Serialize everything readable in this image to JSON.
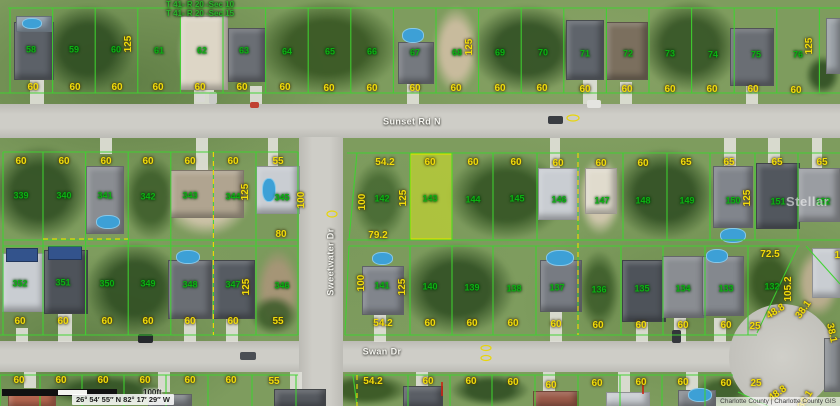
{
  "map": {
    "overlay": {
      "section_labels": [
        "T 41- R 20 -Sec 10",
        "T 41- R 20 -Sec 15"
      ],
      "coordinates": "26° 54′ 55″ N 82° 17′ 29″ W",
      "scale_label": "100ft",
      "attribution": "Charlotte County | Charlotte County GIS",
      "watermark": "Stellar",
      "highlighted_parcel": "143"
    },
    "streets": [
      {
        "id": "sunset-rd-n",
        "name": "Sunset Rd N",
        "x": 412,
        "y": 122,
        "r": 0
      },
      {
        "id": "swan-dr",
        "name": "Swan Dr",
        "x": 382,
        "y": 352,
        "r": 0
      },
      {
        "id": "sweetwater-dr",
        "name": "Sweetwater Dr",
        "x": 331,
        "y": 262,
        "r": -90
      }
    ],
    "parcel_numbers": [
      {
        "n": "58",
        "x": 31,
        "y": 50
      },
      {
        "n": "59",
        "x": 74,
        "y": 50
      },
      {
        "n": "60",
        "x": 116,
        "y": 50
      },
      {
        "n": "61",
        "x": 159,
        "y": 51
      },
      {
        "n": "62",
        "x": 202,
        "y": 51
      },
      {
        "n": "63",
        "x": 244,
        "y": 51
      },
      {
        "n": "64",
        "x": 287,
        "y": 52
      },
      {
        "n": "65",
        "x": 330,
        "y": 52
      },
      {
        "n": "66",
        "x": 372,
        "y": 52
      },
      {
        "n": "67",
        "x": 415,
        "y": 53
      },
      {
        "n": "68",
        "x": 457,
        "y": 53
      },
      {
        "n": "69",
        "x": 500,
        "y": 53
      },
      {
        "n": "70",
        "x": 543,
        "y": 53
      },
      {
        "n": "71",
        "x": 585,
        "y": 54
      },
      {
        "n": "72",
        "x": 628,
        "y": 54
      },
      {
        "n": "73",
        "x": 670,
        "y": 54
      },
      {
        "n": "74",
        "x": 713,
        "y": 55
      },
      {
        "n": "75",
        "x": 756,
        "y": 55
      },
      {
        "n": "76",
        "x": 798,
        "y": 55
      },
      {
        "n": "339",
        "x": 21,
        "y": 196
      },
      {
        "n": "340",
        "x": 64,
        "y": 196
      },
      {
        "n": "341",
        "x": 105,
        "y": 196
      },
      {
        "n": "342",
        "x": 148,
        "y": 197
      },
      {
        "n": "343",
        "x": 190,
        "y": 196
      },
      {
        "n": "344",
        "x": 233,
        "y": 197
      },
      {
        "n": "345",
        "x": 282,
        "y": 198
      },
      {
        "n": "142",
        "x": 382,
        "y": 199
      },
      {
        "n": "143",
        "x": 430,
        "y": 199
      },
      {
        "n": "144",
        "x": 473,
        "y": 200
      },
      {
        "n": "145",
        "x": 517,
        "y": 199
      },
      {
        "n": "146",
        "x": 559,
        "y": 200
      },
      {
        "n": "147",
        "x": 602,
        "y": 201
      },
      {
        "n": "148",
        "x": 643,
        "y": 201
      },
      {
        "n": "149",
        "x": 687,
        "y": 201
      },
      {
        "n": "150",
        "x": 733,
        "y": 201
      },
      {
        "n": "151",
        "x": 778,
        "y": 202
      },
      {
        "n": "152",
        "x": 823,
        "y": 202
      },
      {
        "n": "352",
        "x": 20,
        "y": 284
      },
      {
        "n": "351",
        "x": 63,
        "y": 283
      },
      {
        "n": "350",
        "x": 107,
        "y": 284
      },
      {
        "n": "349",
        "x": 148,
        "y": 284
      },
      {
        "n": "348",
        "x": 190,
        "y": 285
      },
      {
        "n": "347",
        "x": 233,
        "y": 285
      },
      {
        "n": "346",
        "x": 282,
        "y": 286
      },
      {
        "n": "141",
        "x": 382,
        "y": 286
      },
      {
        "n": "140",
        "x": 430,
        "y": 287
      },
      {
        "n": "139",
        "x": 472,
        "y": 288
      },
      {
        "n": "138",
        "x": 514,
        "y": 289
      },
      {
        "n": "137",
        "x": 557,
        "y": 288
      },
      {
        "n": "136",
        "x": 599,
        "y": 290
      },
      {
        "n": "135",
        "x": 642,
        "y": 289
      },
      {
        "n": "134",
        "x": 683,
        "y": 289
      },
      {
        "n": "133",
        "x": 726,
        "y": 289
      },
      {
        "n": "132",
        "x": 772,
        "y": 287
      }
    ],
    "dimensions": [
      {
        "t": "60",
        "x": 33,
        "y": 88
      },
      {
        "t": "60",
        "x": 75,
        "y": 88
      },
      {
        "t": "60",
        "x": 117,
        "y": 88
      },
      {
        "t": "60",
        "x": 158,
        "y": 88
      },
      {
        "t": "60",
        "x": 200,
        "y": 88
      },
      {
        "t": "60",
        "x": 242,
        "y": 88
      },
      {
        "t": "60",
        "x": 285,
        "y": 88
      },
      {
        "t": "60",
        "x": 329,
        "y": 89
      },
      {
        "t": "60",
        "x": 372,
        "y": 89
      },
      {
        "t": "60",
        "x": 415,
        "y": 89
      },
      {
        "t": "60",
        "x": 456,
        "y": 89
      },
      {
        "t": "60",
        "x": 500,
        "y": 89
      },
      {
        "t": "60",
        "x": 542,
        "y": 89
      },
      {
        "t": "60",
        "x": 585,
        "y": 90
      },
      {
        "t": "60",
        "x": 627,
        "y": 90
      },
      {
        "t": "60",
        "x": 670,
        "y": 90
      },
      {
        "t": "60",
        "x": 712,
        "y": 90
      },
      {
        "t": "60",
        "x": 753,
        "y": 90
      },
      {
        "t": "60",
        "x": 796,
        "y": 91
      },
      {
        "t": "125",
        "x": 129,
        "y": 44,
        "r": -90
      },
      {
        "t": "125",
        "x": 470,
        "y": 47,
        "r": -90
      },
      {
        "t": "125",
        "x": 810,
        "y": 46,
        "r": -90
      },
      {
        "t": "60",
        "x": 21,
        "y": 162
      },
      {
        "t": "60",
        "x": 64,
        "y": 162
      },
      {
        "t": "60",
        "x": 106,
        "y": 162
      },
      {
        "t": "60",
        "x": 148,
        "y": 162
      },
      {
        "t": "60",
        "x": 190,
        "y": 162
      },
      {
        "t": "60",
        "x": 233,
        "y": 162
      },
      {
        "t": "55",
        "x": 278,
        "y": 162
      },
      {
        "t": "54.2",
        "x": 385,
        "y": 163
      },
      {
        "t": "60",
        "x": 430,
        "y": 163
      },
      {
        "t": "60",
        "x": 473,
        "y": 163
      },
      {
        "t": "60",
        "x": 516,
        "y": 163
      },
      {
        "t": "60",
        "x": 558,
        "y": 164
      },
      {
        "t": "60",
        "x": 601,
        "y": 164
      },
      {
        "t": "60",
        "x": 643,
        "y": 164
      },
      {
        "t": "65",
        "x": 686,
        "y": 163
      },
      {
        "t": "65",
        "x": 729,
        "y": 163
      },
      {
        "t": "65",
        "x": 777,
        "y": 163
      },
      {
        "t": "65",
        "x": 822,
        "y": 163
      },
      {
        "t": "100",
        "x": 302,
        "y": 200,
        "r": -90
      },
      {
        "t": "125",
        "x": 246,
        "y": 192,
        "r": -90
      },
      {
        "t": "100",
        "x": 363,
        "y": 202,
        "r": -90
      },
      {
        "t": "125",
        "x": 404,
        "y": 198,
        "r": -90
      },
      {
        "t": "125",
        "x": 748,
        "y": 198,
        "r": -90
      },
      {
        "t": "80",
        "x": 281,
        "y": 235
      },
      {
        "t": "79.2",
        "x": 378,
        "y": 236
      },
      {
        "t": "125",
        "x": 247,
        "y": 287,
        "r": -90
      },
      {
        "t": "100",
        "x": 362,
        "y": 283,
        "r": -90
      },
      {
        "t": "125",
        "x": 403,
        "y": 287,
        "r": -90
      },
      {
        "t": "105.2",
        "x": 789,
        "y": 289,
        "r": -90
      },
      {
        "t": "72.5",
        "x": 770,
        "y": 255
      },
      {
        "t": "60",
        "x": 20,
        "y": 322
      },
      {
        "t": "60",
        "x": 63,
        "y": 322
      },
      {
        "t": "60",
        "x": 107,
        "y": 322
      },
      {
        "t": "60",
        "x": 148,
        "y": 322
      },
      {
        "t": "60",
        "x": 190,
        "y": 322
      },
      {
        "t": "60",
        "x": 233,
        "y": 322
      },
      {
        "t": "55",
        "x": 278,
        "y": 322
      },
      {
        "t": "54.2",
        "x": 383,
        "y": 324
      },
      {
        "t": "60",
        "x": 430,
        "y": 324
      },
      {
        "t": "60",
        "x": 472,
        "y": 324
      },
      {
        "t": "60",
        "x": 513,
        "y": 324
      },
      {
        "t": "60",
        "x": 556,
        "y": 325
      },
      {
        "t": "60",
        "x": 598,
        "y": 326
      },
      {
        "t": "60",
        "x": 641,
        "y": 326
      },
      {
        "t": "60",
        "x": 683,
        "y": 326
      },
      {
        "t": "60",
        "x": 726,
        "y": 326
      },
      {
        "t": "25",
        "x": 755,
        "y": 327
      },
      {
        "t": "48.8",
        "x": 776,
        "y": 312,
        "r": -32
      },
      {
        "t": "38.1",
        "x": 804,
        "y": 310,
        "r": -55
      },
      {
        "t": "38.1",
        "x": 831,
        "y": 333,
        "r": 78
      },
      {
        "t": "14",
        "x": 840,
        "y": 256
      },
      {
        "t": "60",
        "x": 19,
        "y": 381
      },
      {
        "t": "60",
        "x": 61,
        "y": 381
      },
      {
        "t": "60",
        "x": 103,
        "y": 381
      },
      {
        "t": "60",
        "x": 145,
        "y": 381
      },
      {
        "t": "60",
        "x": 190,
        "y": 381
      },
      {
        "t": "60",
        "x": 231,
        "y": 381
      },
      {
        "t": "55",
        "x": 274,
        "y": 382
      },
      {
        "t": "54.2",
        "x": 373,
        "y": 382
      },
      {
        "t": "60",
        "x": 428,
        "y": 382
      },
      {
        "t": "60",
        "x": 471,
        "y": 382
      },
      {
        "t": "60",
        "x": 513,
        "y": 383
      },
      {
        "t": "60",
        "x": 551,
        "y": 386
      },
      {
        "t": "60",
        "x": 597,
        "y": 384
      },
      {
        "t": "60",
        "x": 641,
        "y": 383
      },
      {
        "t": "60",
        "x": 683,
        "y": 383
      },
      {
        "t": "60",
        "x": 726,
        "y": 384
      },
      {
        "t": "25",
        "x": 756,
        "y": 384
      },
      {
        "t": "48.8",
        "x": 778,
        "y": 394,
        "r": -35
      },
      {
        "t": "38.1",
        "x": 806,
        "y": 400,
        "r": -58
      }
    ],
    "colors": {
      "lot_line": "#3ed32f",
      "parcel_number": "#0cb112",
      "dimension": "#f2dc0a",
      "highlight_fill": "#d5e424",
      "easement_dashed": "#e8d50a",
      "street_label": "#f5f5f0"
    }
  }
}
